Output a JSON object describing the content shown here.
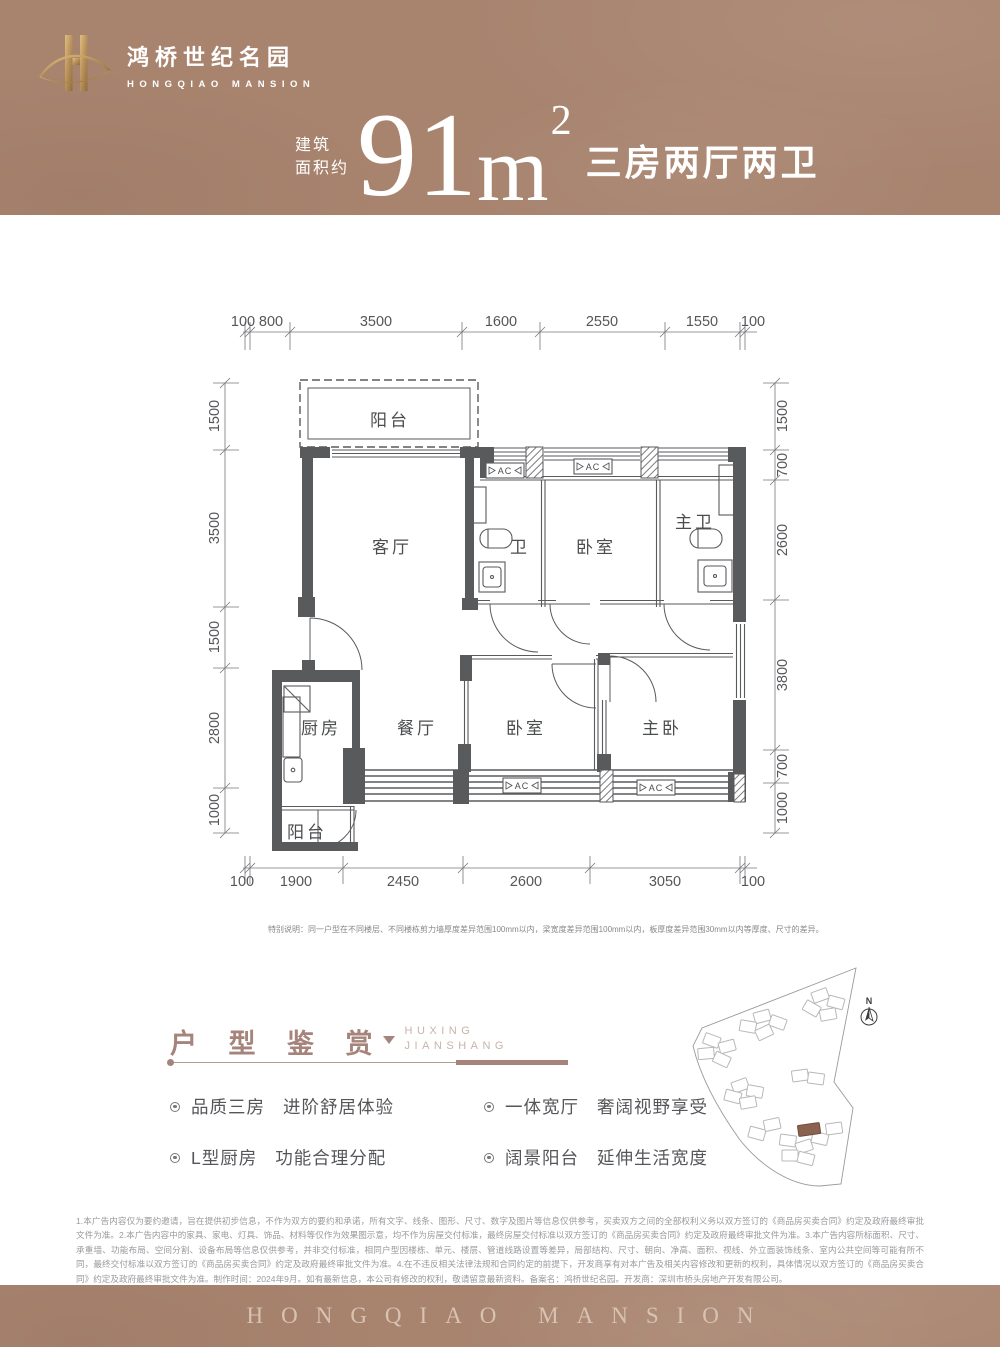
{
  "brand": {
    "cn": "鸿桥世纪名园",
    "en": "HONGQIAO MANSION"
  },
  "title": {
    "label1": "建筑",
    "label2": "面积约",
    "area": "91",
    "unit": "m",
    "sup": "2",
    "rooms": "三房两厅两卫"
  },
  "plan": {
    "dims_top": [
      "100",
      "800",
      "3500",
      "1600",
      "2550",
      "1550",
      "100"
    ],
    "dims_bottom": [
      "100",
      "1900",
      "2450",
      "2600",
      "3050",
      "100"
    ],
    "dims_left": [
      "1500",
      "3500",
      "1500",
      "2800",
      "1000"
    ],
    "dims_right": [
      "1500",
      "700",
      "2600",
      "3800",
      "700",
      "1000"
    ],
    "rooms": {
      "balcony_top": "阳台",
      "living": "客厅",
      "bath": "卫",
      "bedroom_a": "卧室",
      "master_bath": "主卫",
      "kitchen": "厨房",
      "dining": "餐厅",
      "bedroom_b": "卧室",
      "master_bedroom": "主卧",
      "balcony_bottom": "阳台"
    },
    "ac": "AC",
    "note": "特别说明：同一户型在不同楼层、不同楼栋剪力墙厚度差异范围100mm以内，梁宽度差异范围100mm以内，板厚度差异范围30mm以内等厚度、尺寸的差异。"
  },
  "section": {
    "cn": "户 型 鉴 赏",
    "en1": "HUXING",
    "en2": "JIANSHANG"
  },
  "features": [
    {
      "name": "品质三房",
      "desc": "进阶舒居体验"
    },
    {
      "name": "L型厨房",
      "desc": "功能合理分配"
    },
    {
      "name": "一体宽厅",
      "desc": "奢阔视野享受"
    },
    {
      "name": "阔景阳台",
      "desc": "延伸生活宽度"
    }
  ],
  "siteplan": {
    "north": "N"
  },
  "legal": "1.本广告内容仅为要约邀请，旨在提供初步信息，不作为双方的要约和承诺，所有文字、线条、图形、尺寸、数字及图片等信息仅供参考，买卖双方之间的全部权利义务以双方签订的《商品房买卖合同》约定及政府最终审批文件为准。2.本广告内容中的家具、家电、灯具、饰品、材料等仅作为效果图示意，均不作为房屋交付标准，最终房屋交付标准以双方签订的《商品房买卖合同》约定及政府最终审批文件为准。3.本广告内容所标面积、尺寸、承重墙、功能布局、空间分割、设备布局等信息仅供参考，并非交付标准，相同户型因楼栋、单元、楼层、管道线路设置等差异，局部结构、尺寸、朝向、净高、面积、视线、外立面装饰线条、室内公共空间等可能有所不同，最终交付标准以双方签订的《商品房买卖合同》约定及政府最终审批文件为准。4.在不违反相关法律法规和合同约定的前提下，开发商享有对本广告及相关内容修改和更新的权利，具体情况以双方签订的《商品房买卖合同》约定及政府最终审批文件为准。制作时间：2024年9月。如有最新信息，本公司有修改的权利，敬请留意最新资料。备案名：鸿桥世纪名园。开发商：深圳市桥头房地产开发有限公司。",
  "footer": {
    "en": "HONGQIAO MANSION"
  },
  "colors": {
    "brand_brown": "#a8846f",
    "accent_brown": "#a6847c",
    "gold": "#c9a063",
    "wall_gray": "#595a5c",
    "text_gray": "#55565a",
    "legal_gray": "#989a9d",
    "footer_text": "#d8c2b2",
    "site_highlight": "#8a6250"
  }
}
